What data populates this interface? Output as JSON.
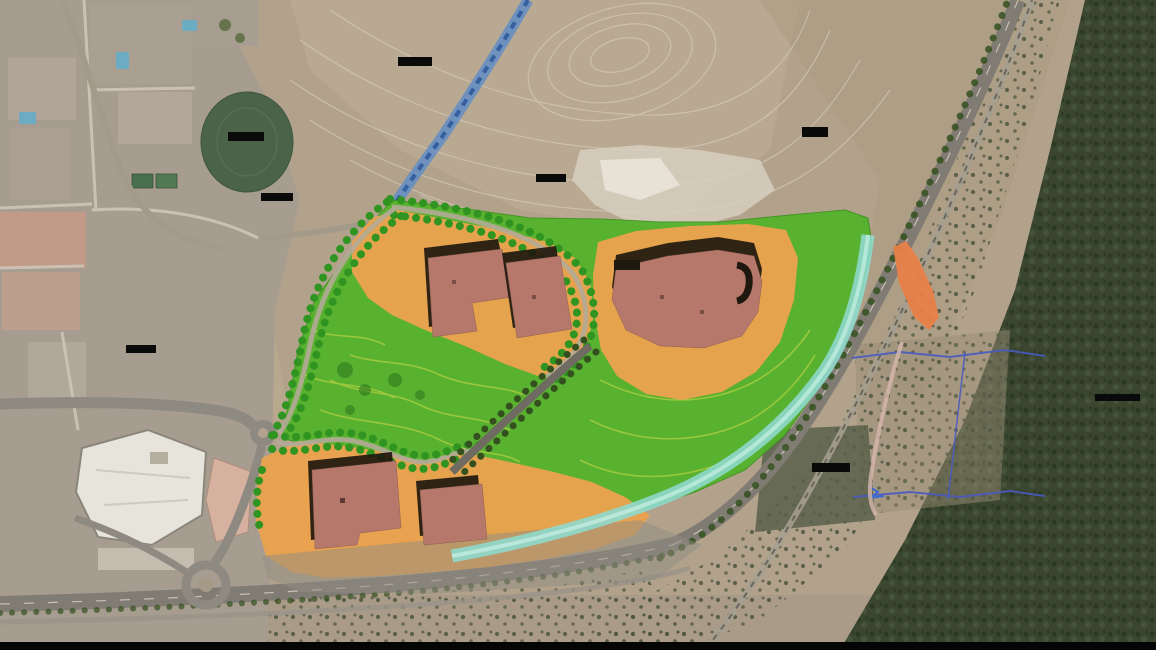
{
  "scene": {
    "kind": "aerial-site-plan",
    "description": "Satellite aerial photograph with a colored landscape masterplan overlay: three orange development parcels with red-roofed buildings, a bright green park crossed by tree-lined avenues and a diagonal road, a cyan drainage channel, a blue-marked stream, surrounding city blocks with pools and a white mall, two roundabouts, a highway and rail corridor running to the north-east, dark forest along the east edge, and blacked-out redacted label bars.",
    "visible_text": "none - all map labels are blacked out"
  },
  "colors": {
    "terrain_tan": "#b2a28c",
    "terrain_light": "#c3b29a",
    "urban_gray": "#a69c8f",
    "forest_green": "#3a462f",
    "road_gray": "#8e8a82",
    "highway_gray": "#807c74",
    "contour_white": "#ded7c7",
    "park_green": "#54b22b",
    "contour_yellow_green": "#a6cc40",
    "tree_green_dark": "#2f9420",
    "tree_green_deep": "#35501f",
    "parcel_orange": "#e9a24e",
    "building_red": "#b5786b",
    "building_shadow": "#1f180f",
    "channel_cyan": "#8fd9cc",
    "channel_light": "#c9efe6",
    "stream_blue": "#5b8cc8",
    "stream_blue_dark": "#2f5a9a",
    "ramp_orange": "#e87f48",
    "survey_blue": "#4a5ac0",
    "survey_pink": "#d8b8ac",
    "pool_blue": "#6cacc2",
    "mall_white": "#e7e4dc",
    "oval_park_green": "#4b6349",
    "redaction_black": "#0a0a0a",
    "frame_black": "#050505"
  },
  "features": {
    "parcels": [
      "west development parcel",
      "east development parcel",
      "south development parcel"
    ],
    "building_clusters": 3,
    "roundabouts": 2,
    "redacted_labels": 8,
    "overlays": [
      "green park with contour lines",
      "tree-lined avenues",
      "cyan drainage channel",
      "blue stream marking",
      "orange slip-road marking",
      "blue survey boundary lines"
    ]
  }
}
